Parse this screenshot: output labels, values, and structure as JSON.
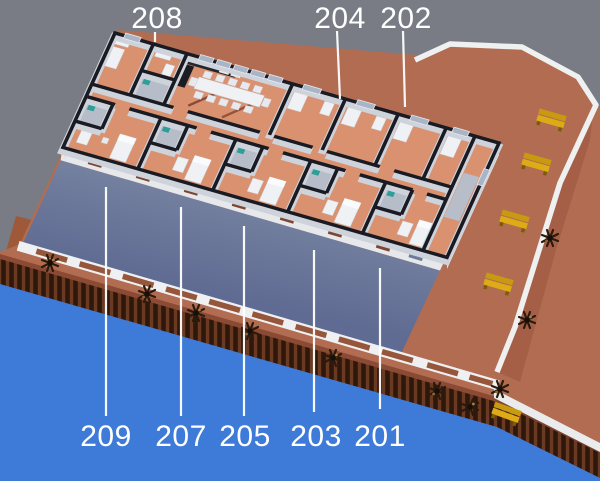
{
  "title": "3D cutaway floor plan of pier building with numbered rooms",
  "labels": {
    "top": [
      "208",
      "204",
      "202"
    ],
    "bottom": [
      "209",
      "207",
      "205",
      "203",
      "201"
    ]
  },
  "colors": {
    "sky": "#797c85",
    "water": "#3e7bd8",
    "deck": "#b26c52",
    "deck_edge": "#8a4a34",
    "roof_slab_light": "#75819f",
    "roof_slab_dark": "#5f6b92",
    "curb_white": "#eff1f1",
    "fence_opening": "#95563c",
    "wall_line": "#191a22",
    "wall_face": "#ced3db",
    "room_floor": "#d9916f",
    "bath_floor": "#b6bdc8",
    "window_glass": "#a9b5c6",
    "furniture": "#eff1f4",
    "kitchen_counter": "#25262d",
    "bench_yellow": "#dcab15",
    "palm_dark": "#2c1a0d",
    "ramp_brown": "#9e5a38",
    "label_text": "#ffffff"
  }
}
